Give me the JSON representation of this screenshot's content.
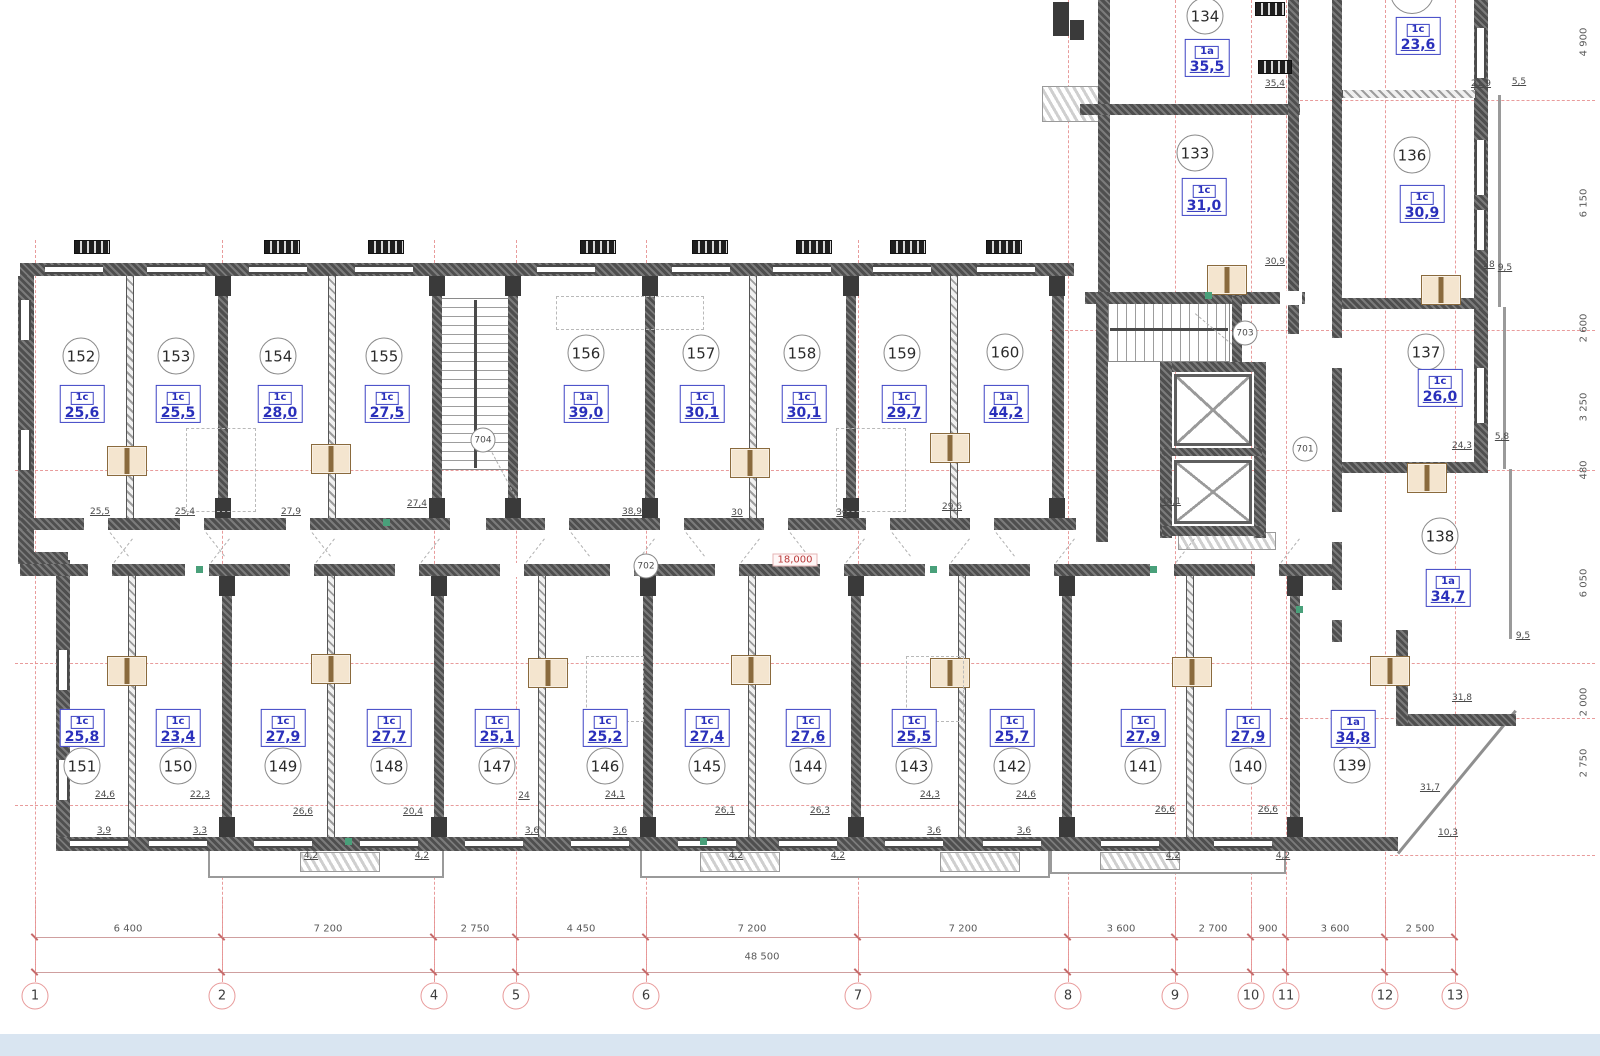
{
  "drawing": {
    "elevation_mark": "18,000",
    "overall_dimension": "48 500"
  },
  "rooms": [
    {
      "num": "152",
      "type": "1c",
      "area": "25,6",
      "cx": 81,
      "cy": 356,
      "bx": 82,
      "by": 404
    },
    {
      "num": "153",
      "type": "1c",
      "area": "25,5",
      "cx": 176,
      "cy": 356,
      "bx": 178,
      "by": 404
    },
    {
      "num": "154",
      "type": "1c",
      "area": "28,0",
      "cx": 278,
      "cy": 356,
      "bx": 280,
      "by": 404
    },
    {
      "num": "155",
      "type": "1c",
      "area": "27,5",
      "cx": 384,
      "cy": 356,
      "bx": 387,
      "by": 404
    },
    {
      "num": "156",
      "type": "1a",
      "area": "39,0",
      "cx": 586,
      "cy": 353,
      "bx": 586,
      "by": 404
    },
    {
      "num": "157",
      "type": "1c",
      "area": "30,1",
      "cx": 701,
      "cy": 353,
      "bx": 702,
      "by": 404
    },
    {
      "num": "158",
      "type": "1c",
      "area": "30,1",
      "cx": 802,
      "cy": 353,
      "bx": 804,
      "by": 404
    },
    {
      "num": "159",
      "type": "1c",
      "area": "29,7",
      "cx": 902,
      "cy": 353,
      "bx": 904,
      "by": 404
    },
    {
      "num": "160",
      "type": "1a",
      "area": "44,2",
      "cx": 1005,
      "cy": 352,
      "bx": 1006,
      "by": 404
    },
    {
      "num": "134",
      "type": "1a",
      "area": "35,5",
      "cx": 1205,
      "cy": 16,
      "bx": 1207,
      "by": 58
    },
    {
      "num": "133",
      "type": "1c",
      "area": "31,0",
      "cx": 1195,
      "cy": 153,
      "bx": 1204,
      "by": 197
    },
    {
      "num": "136",
      "type": "1c",
      "area": "30,9",
      "cx": 1412,
      "cy": 155,
      "bx": 1422,
      "by": 204
    },
    {
      "num": "137",
      "type": "1c",
      "area": "26,0",
      "cx": 1426,
      "cy": 352,
      "bx": 1440,
      "by": 388
    },
    {
      "num": "138",
      "type": "1a",
      "area": "34,7",
      "cx": 1440,
      "cy": 536,
      "bx": 1448,
      "by": 588
    },
    {
      "num": "151",
      "type": "1c",
      "area": "25,8",
      "cx": 82,
      "cy": 766,
      "bx": 82,
      "by": 728
    },
    {
      "num": "150",
      "type": "1c",
      "area": "23,4",
      "cx": 178,
      "cy": 766,
      "bx": 178,
      "by": 728
    },
    {
      "num": "149",
      "type": "1c",
      "area": "27,9",
      "cx": 283,
      "cy": 766,
      "bx": 283,
      "by": 728
    },
    {
      "num": "148",
      "type": "1c",
      "area": "27,7",
      "cx": 389,
      "cy": 766,
      "bx": 389,
      "by": 728
    },
    {
      "num": "147",
      "type": "1c",
      "area": "25,1",
      "cx": 497,
      "cy": 766,
      "bx": 497,
      "by": 728
    },
    {
      "num": "146",
      "type": "1c",
      "area": "25,2",
      "cx": 605,
      "cy": 766,
      "bx": 605,
      "by": 728
    },
    {
      "num": "145",
      "type": "1c",
      "area": "27,4",
      "cx": 707,
      "cy": 766,
      "bx": 707,
      "by": 728
    },
    {
      "num": "144",
      "type": "1c",
      "area": "27,6",
      "cx": 808,
      "cy": 766,
      "bx": 808,
      "by": 728
    },
    {
      "num": "143",
      "type": "1c",
      "area": "25,5",
      "cx": 914,
      "cy": 766,
      "bx": 914,
      "by": 728
    },
    {
      "num": "142",
      "type": "1c",
      "area": "25,7",
      "cx": 1012,
      "cy": 766,
      "bx": 1012,
      "by": 728
    },
    {
      "num": "141",
      "type": "1c",
      "area": "27,9",
      "cx": 1143,
      "cy": 766,
      "bx": 1143,
      "by": 728
    },
    {
      "num": "140",
      "type": "1c",
      "area": "27,9",
      "cx": 1248,
      "cy": 766,
      "bx": 1248,
      "by": 728
    },
    {
      "num": "139",
      "type": "1a",
      "area": "34,8",
      "cx": 1352,
      "cy": 765,
      "bx": 1353,
      "by": 729
    }
  ],
  "partial_badges": [
    {
      "type": "1c",
      "area": "23,6",
      "x": 1418,
      "y": 36
    }
  ],
  "detail_circles": [
    {
      "label": "704",
      "x": 483,
      "y": 440
    },
    {
      "label": "702",
      "x": 646,
      "y": 566
    },
    {
      "label": "703",
      "x": 1245,
      "y": 333
    },
    {
      "label": "701",
      "x": 1305,
      "y": 449
    }
  ],
  "small_dims": [
    {
      "t": "25,5",
      "x": 100,
      "y": 512
    },
    {
      "t": "25,4",
      "x": 185,
      "y": 512
    },
    {
      "t": "27,9",
      "x": 291,
      "y": 512
    },
    {
      "t": "27,4",
      "x": 417,
      "y": 504
    },
    {
      "t": "38,9",
      "x": 632,
      "y": 512
    },
    {
      "t": "30",
      "x": 737,
      "y": 513
    },
    {
      "t": "30",
      "x": 842,
      "y": 513
    },
    {
      "t": "29,6",
      "x": 952,
      "y": 507
    },
    {
      "t": "44,1",
      "x": 1171,
      "y": 502
    },
    {
      "t": "35,4",
      "x": 1275,
      "y": 84
    },
    {
      "t": "21,9",
      "x": 1481,
      "y": 84
    },
    {
      "t": "5,5",
      "x": 1519,
      "y": 82
    },
    {
      "t": "30,9",
      "x": 1275,
      "y": 262
    },
    {
      "t": "28",
      "x": 1489,
      "y": 265
    },
    {
      "t": "9,5",
      "x": 1505,
      "y": 268
    },
    {
      "t": "24,3",
      "x": 1462,
      "y": 446
    },
    {
      "t": "5,8",
      "x": 1502,
      "y": 437
    },
    {
      "t": "31,8",
      "x": 1462,
      "y": 698
    },
    {
      "t": "9,5",
      "x": 1523,
      "y": 636
    },
    {
      "t": "31,7",
      "x": 1430,
      "y": 788
    },
    {
      "t": "10,3",
      "x": 1448,
      "y": 833
    },
    {
      "t": "24,6",
      "x": 105,
      "y": 795
    },
    {
      "t": "22,3",
      "x": 200,
      "y": 795
    },
    {
      "t": "26,6",
      "x": 303,
      "y": 812
    },
    {
      "t": "20,4",
      "x": 413,
      "y": 812
    },
    {
      "t": "24",
      "x": 524,
      "y": 796
    },
    {
      "t": "24,1",
      "x": 615,
      "y": 795
    },
    {
      "t": "26,1",
      "x": 725,
      "y": 811
    },
    {
      "t": "26,3",
      "x": 820,
      "y": 811
    },
    {
      "t": "24,3",
      "x": 930,
      "y": 795
    },
    {
      "t": "24,6",
      "x": 1026,
      "y": 795
    },
    {
      "t": "26,6",
      "x": 1165,
      "y": 810
    },
    {
      "t": "26,6",
      "x": 1268,
      "y": 810
    },
    {
      "t": "3,9",
      "x": 104,
      "y": 831
    },
    {
      "t": "3,3",
      "x": 200,
      "y": 831
    },
    {
      "t": "4,2",
      "x": 311,
      "y": 856
    },
    {
      "t": "4,2",
      "x": 422,
      "y": 856
    },
    {
      "t": "3,6",
      "x": 532,
      "y": 831
    },
    {
      "t": "3,6",
      "x": 620,
      "y": 831
    },
    {
      "t": "4,2",
      "x": 736,
      "y": 856
    },
    {
      "t": "4,2",
      "x": 838,
      "y": 856
    },
    {
      "t": "3,6",
      "x": 934,
      "y": 831
    },
    {
      "t": "3,6",
      "x": 1024,
      "y": 831
    },
    {
      "t": "4,2",
      "x": 1173,
      "y": 856
    },
    {
      "t": "4,2",
      "x": 1283,
      "y": 856
    }
  ],
  "bottom_dims": [
    {
      "label": "6 400",
      "x": 128
    },
    {
      "label": "7 200",
      "x": 328
    },
    {
      "label": "2 750",
      "x": 475
    },
    {
      "label": "4 450",
      "x": 581
    },
    {
      "label": "7 200",
      "x": 752
    },
    {
      "label": "7 200",
      "x": 963
    },
    {
      "label": "3 600",
      "x": 1121
    },
    {
      "label": "2 700",
      "x": 1213
    },
    {
      "label": "900",
      "x": 1268
    },
    {
      "label": "3 600",
      "x": 1335
    },
    {
      "label": "2 500",
      "x": 1420
    }
  ],
  "right_dims": [
    {
      "label": "4 900",
      "y": 42
    },
    {
      "label": "6 150",
      "y": 203
    },
    {
      "label": "2 600",
      "y": 328
    },
    {
      "label": "3 250",
      "y": 407
    },
    {
      "label": "480",
      "y": 470
    },
    {
      "label": "6 050",
      "y": 583
    },
    {
      "label": "2 000",
      "y": 702
    },
    {
      "label": "2 750",
      "y": 763
    }
  ],
  "axes": [
    {
      "label": "1",
      "x": 35
    },
    {
      "label": "2",
      "x": 222
    },
    {
      "label": "4",
      "x": 434
    },
    {
      "label": "5",
      "x": 516
    },
    {
      "label": "6",
      "x": 646
    },
    {
      "label": "7",
      "x": 858
    },
    {
      "label": "8",
      "x": 1068
    },
    {
      "label": "9",
      "x": 1175
    },
    {
      "label": "10",
      "x": 1251
    },
    {
      "label": "11",
      "x": 1286
    },
    {
      "label": "12",
      "x": 1385
    },
    {
      "label": "13",
      "x": 1455
    }
  ]
}
